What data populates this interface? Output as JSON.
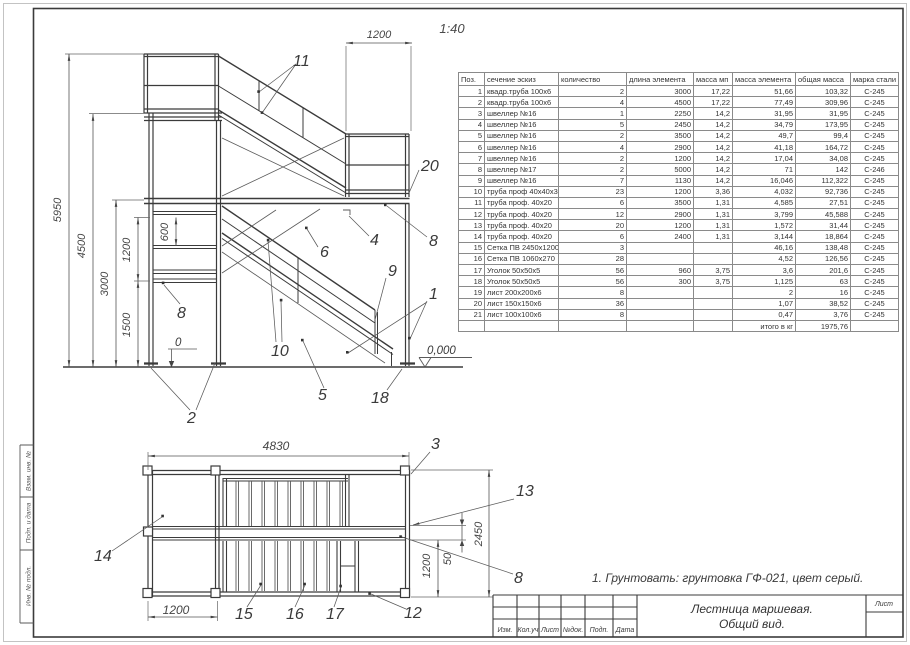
{
  "sheet": {
    "scale": "1:40",
    "note": "1. Грунтовать: грунтовка ГФ-021, цвет серый.",
    "title_line1": "Лестница маршевая.",
    "title_line2": "Общий вид.",
    "sheet_cell_label": "Лист",
    "stamp_columns": [
      "Изм.",
      "Кол.уч",
      "Лист",
      "№док.",
      "Подп.",
      "Дата"
    ],
    "side_strip": [
      "Взам. инв. №",
      "Подп. и дата",
      "Инв. № подл."
    ]
  },
  "table": {
    "columns": [
      "Поз.",
      "сечение эскиз",
      "количество",
      "длина элемента",
      "масса мп",
      "масса элемента",
      "общая масса",
      "марка стали"
    ],
    "rows": [
      [
        "1",
        "квадр.труба 100х6",
        "2",
        "3000",
        "17,22",
        "51,66",
        "103,32",
        "С-245"
      ],
      [
        "2",
        "квадр.труба 100х6",
        "4",
        "4500",
        "17,22",
        "77,49",
        "309,96",
        "С-245"
      ],
      [
        "3",
        "швеллер №16",
        "1",
        "2250",
        "14,2",
        "31,95",
        "31,95",
        "С-245"
      ],
      [
        "4",
        "швеллер №16",
        "5",
        "2450",
        "14,2",
        "34,79",
        "173,95",
        "С-245"
      ],
      [
        "5",
        "швеллер №16",
        "2",
        "3500",
        "14,2",
        "49,7",
        "99,4",
        "С-245"
      ],
      [
        "6",
        "швеллер №16",
        "4",
        "2900",
        "14,2",
        "41,18",
        "164,72",
        "С-245"
      ],
      [
        "7",
        "швеллер №16",
        "2",
        "1200",
        "14,2",
        "17,04",
        "34,08",
        "С-245"
      ],
      [
        "8",
        "швеллер №17",
        "2",
        "5000",
        "14,2",
        "71",
        "142",
        "С-246"
      ],
      [
        "9",
        "швеллер №16",
        "7",
        "1130",
        "14,2",
        "16,046",
        "112,322",
        "С-245"
      ],
      [
        "10",
        "труба проф 40х40х3",
        "23",
        "1200",
        "3,36",
        "4,032",
        "92,736",
        "С-245"
      ],
      [
        "11",
        "труба проф. 40х20",
        "6",
        "3500",
        "1,31",
        "4,585",
        "27,51",
        "С-245"
      ],
      [
        "12",
        "труба проф. 40х20",
        "12",
        "2900",
        "1,31",
        "3,799",
        "45,588",
        "С-245"
      ],
      [
        "13",
        "труба проф. 40х20",
        "20",
        "1200",
        "1,31",
        "1,572",
        "31,44",
        "С-245"
      ],
      [
        "14",
        "труба проф. 40х20",
        "6",
        "2400",
        "1,31",
        "3,144",
        "18,864",
        "С-245"
      ],
      [
        "15",
        "Сетка ПВ 2450х1200",
        "3",
        "",
        "",
        "46,16",
        "138,48",
        "С-245"
      ],
      [
        "16",
        "Сетка ПВ 1060х270",
        "28",
        "",
        "",
        "4,52",
        "126,56",
        "С-245"
      ],
      [
        "17",
        "Уголок 50х50х5",
        "56",
        "960",
        "3,75",
        "3,6",
        "201,6",
        "С-245"
      ],
      [
        "18",
        "Уголок 50х50х5",
        "56",
        "300",
        "3,75",
        "1,125",
        "63",
        "С-245"
      ],
      [
        "19",
        "лист 200х200х6",
        "8",
        "",
        "",
        "2",
        "16",
        "С-245"
      ],
      [
        "20",
        "лист 150х150х6",
        "36",
        "",
        "",
        "1,07",
        "38,52",
        "С-245"
      ],
      [
        "21",
        "лист 100х100х6",
        "8",
        "",
        "",
        "0,47",
        "3,76",
        "С-245"
      ],
      [
        "",
        "",
        "",
        "",
        "",
        "итого в кг",
        "1975,76",
        ""
      ]
    ]
  },
  "elevation": {
    "dims": {
      "h_total": "5950",
      "h_platform": "4500",
      "h_mid": "3000",
      "h_lower": "1500",
      "v_1200": "1200",
      "v_600": "600",
      "landing_w": "1200"
    },
    "levels": {
      "zero": "0",
      "datum": "0,000"
    },
    "callouts": {
      "c11": "11",
      "c20": "20",
      "c8r": "8",
      "c4": "4",
      "c6": "6",
      "c9": "9",
      "c1": "1",
      "c10": "10",
      "c5": "5",
      "c18": "18",
      "c2": "2",
      "c8l": "8"
    }
  },
  "plan": {
    "dims": {
      "w_total": "4830",
      "w_bay": "1200",
      "d_total": "2450",
      "d_stair": "1200",
      "d_gap": "50"
    },
    "callouts": {
      "c14": "14",
      "c3": "3",
      "c13": "13",
      "c8": "8",
      "c15": "15",
      "c16": "16",
      "c17": "17",
      "c12": "12"
    }
  }
}
